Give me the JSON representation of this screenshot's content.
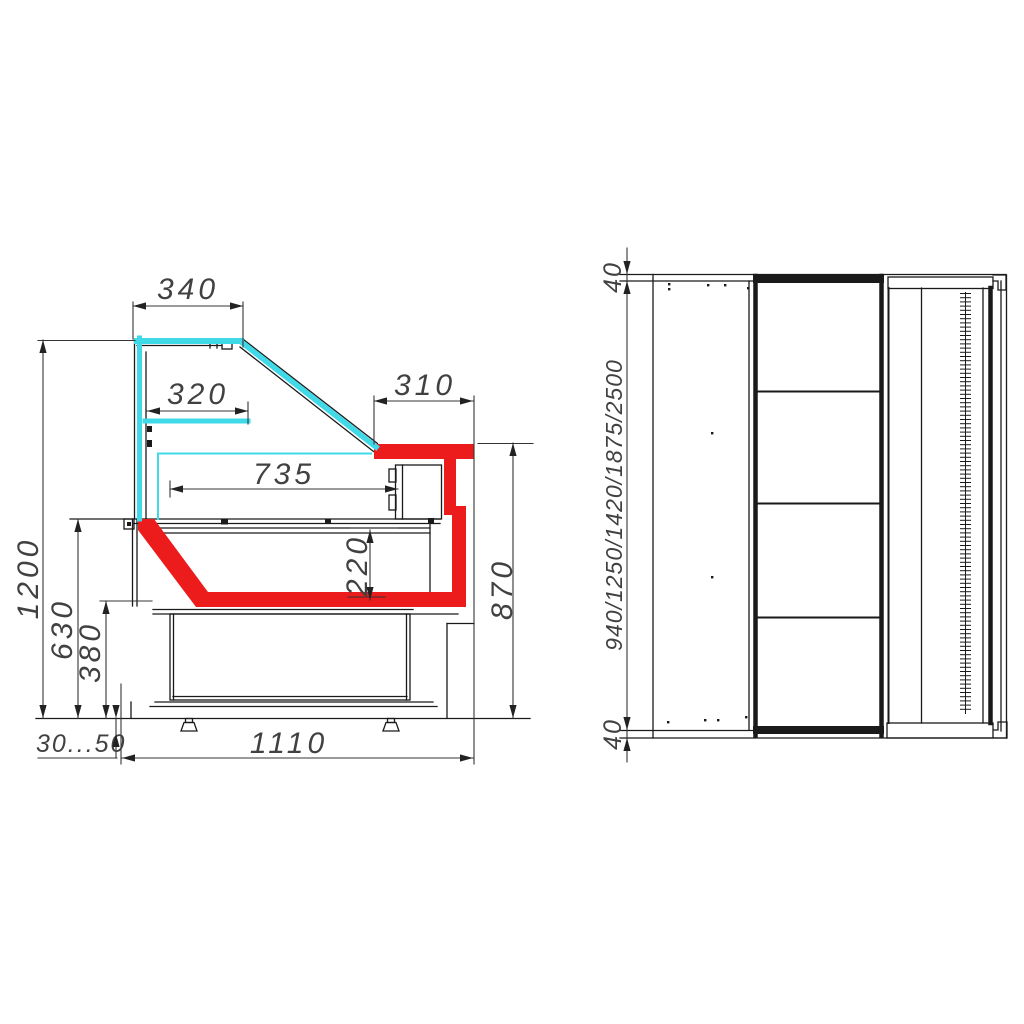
{
  "drawing": {
    "type": "refrigerated display counter technical drawing",
    "views": {
      "side_view_name": "side-section-view",
      "plan_view_name": "plan-view"
    }
  },
  "side_view": {
    "labels": {
      "canopy_width": "340",
      "shelf_width": "320",
      "worktop_depth": "310",
      "inner_depth": "735",
      "total_height": "1200",
      "counter_height": "630",
      "base_height": "380",
      "well_depth": "220",
      "worktop_height": "870",
      "feet_range": "30...50",
      "base_length": "1110"
    }
  },
  "plan_view": {
    "labels": {
      "panel_top": "40",
      "panel_bottom": "40",
      "lengths": "940/1250/1420/1875/2500"
    }
  },
  "colors": {
    "glass": "#3FD9E8",
    "accent_red": "#ED1C1C",
    "line": "#1A1A1A",
    "label": "#414141",
    "background": "#FFFFFF"
  }
}
